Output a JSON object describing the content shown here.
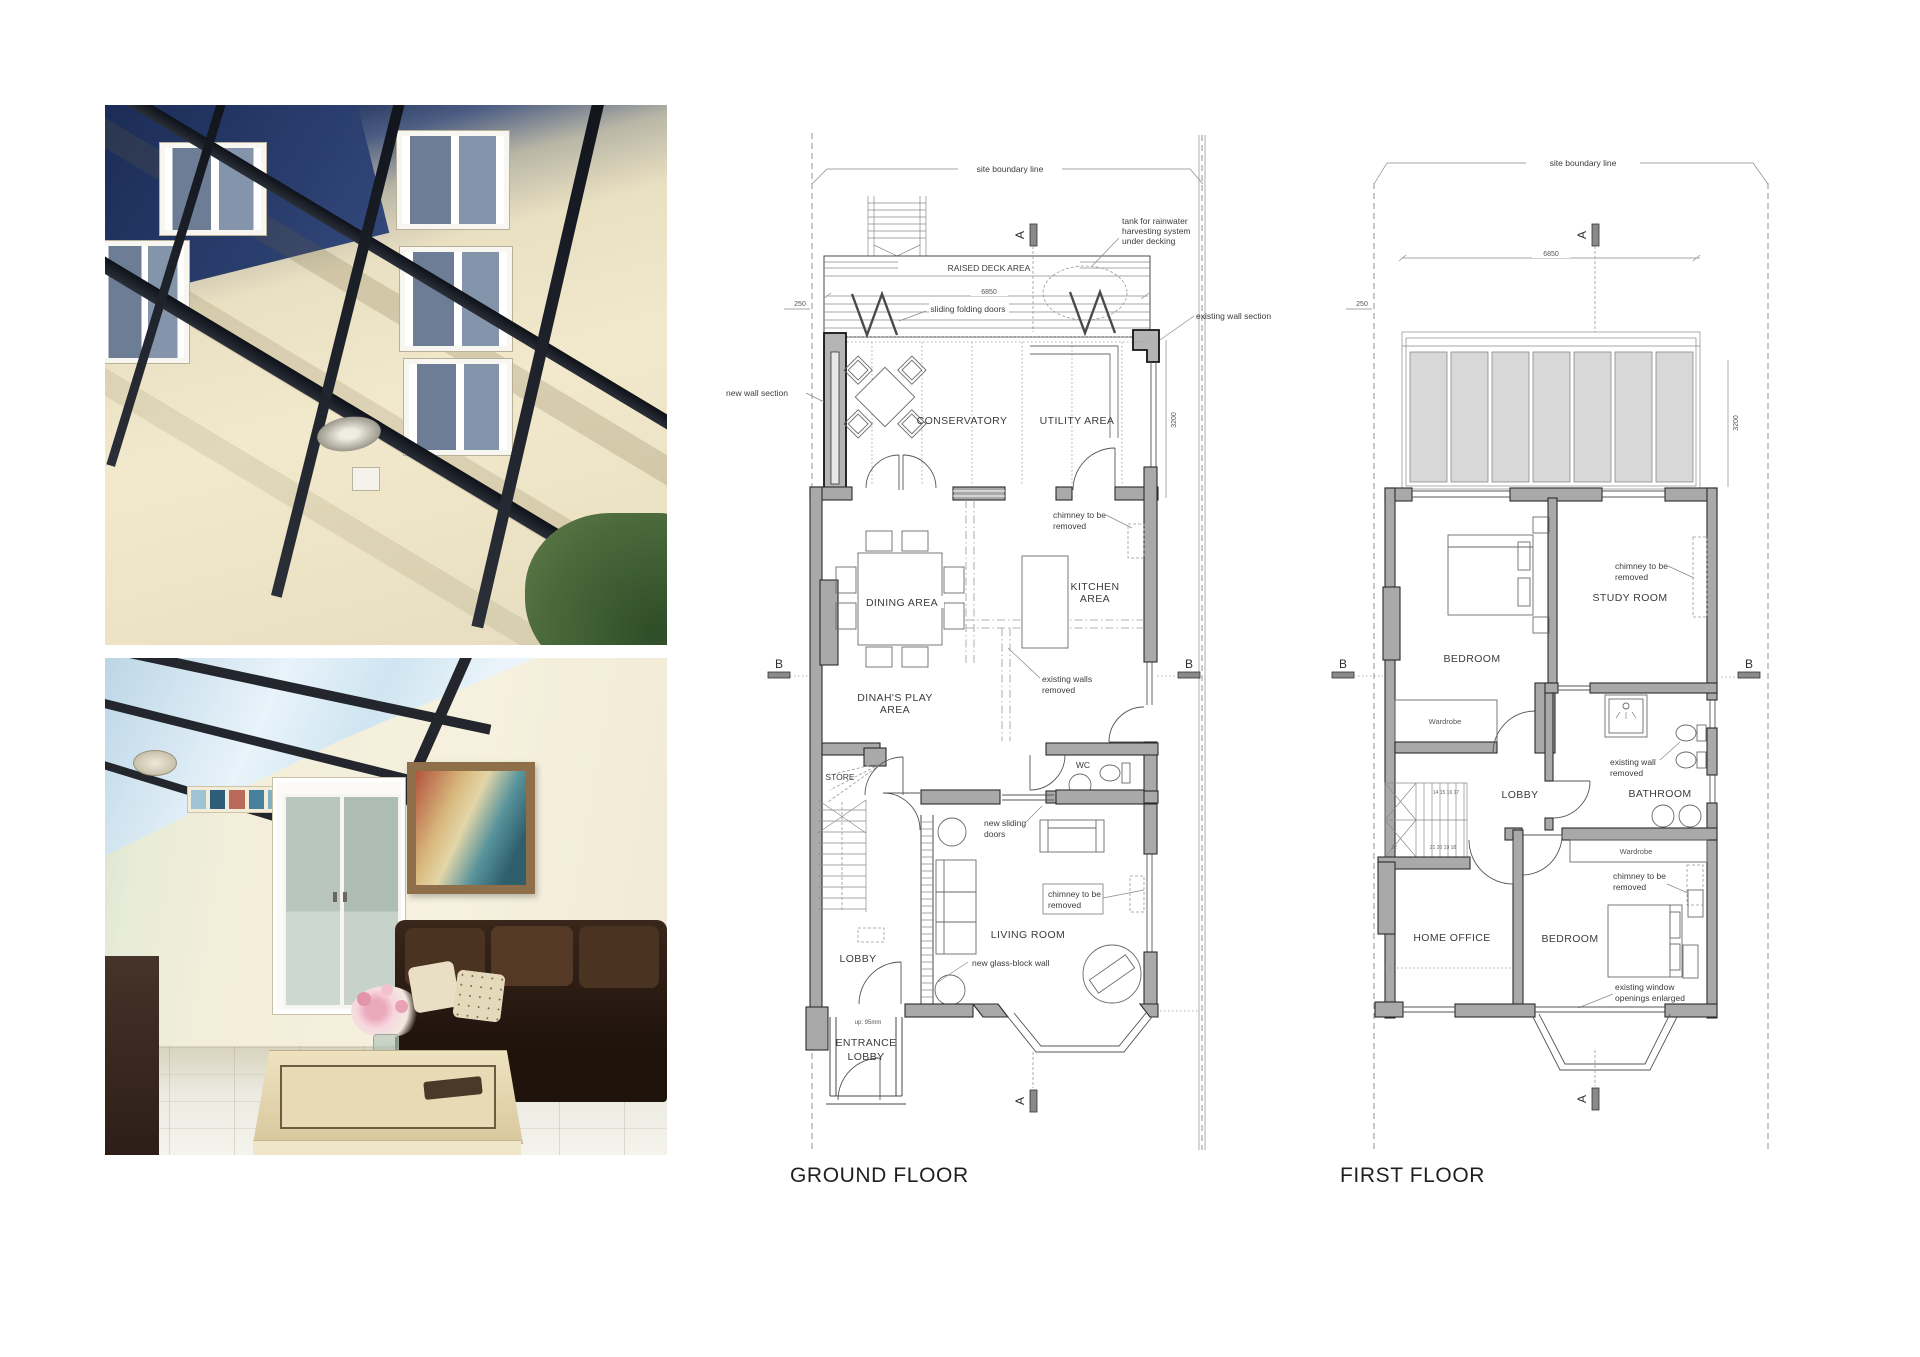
{
  "shared": {
    "site_boundary_line": "site boundary line",
    "marker_a": "A",
    "marker_b": "B",
    "dim_6850": "6850",
    "dim_250": "250",
    "dim_3200": "3200",
    "chimney_line1": "chimney to be",
    "chimney_line2": "removed",
    "wardrobe": "Wardrobe"
  },
  "ground_floor": {
    "title": "GROUND FLOOR",
    "raised_deck_area": "RAISED DECK AREA",
    "sliding_folding_doors": "sliding folding doors",
    "tank_line1": "tank for rainwater",
    "tank_line2": "harvesting system",
    "tank_line3": "under decking",
    "new_wall_section": "new wall section",
    "existing_wall_section": "existing wall section",
    "conservatory": "CONSERVATORY",
    "utility_area": "UTILITY AREA",
    "kitchen_line1": "KITCHEN",
    "kitchen_line2": "AREA",
    "dining_area": "DINING AREA",
    "existing_walls_line1": "existing walls",
    "existing_walls_line2": "removed",
    "play_line1": "DINAH'S PLAY",
    "play_line2": "AREA",
    "store": "STORE",
    "wc": "WC",
    "new_sliding_line1": "new sliding",
    "new_sliding_line2": "doors",
    "living_room": "LIVING ROOM",
    "lobby": "LOBBY",
    "glass_block_wall": "new glass-block wall",
    "entrance_line1": "ENTRANCE",
    "entrance_line2": "LOBBY",
    "up_note": "up: 95mm"
  },
  "first_floor": {
    "title": "FIRST FLOOR",
    "bedroom_front": "BEDROOM",
    "study_room": "STUDY ROOM",
    "lobby": "LOBBY",
    "bathroom": "BATHROOM",
    "existing_wall_line1": "existing wall",
    "existing_wall_line2": "removed",
    "home_office": "HOME OFFICE",
    "bedroom_rear": "BEDROOM",
    "window_note_line1": "existing window",
    "window_note_line2": "openings enlarged",
    "stairs_upper_numbers": "14  15  16  17",
    "stairs_num_22": "22",
    "stairs_lower_numbers": "21  20  19  18"
  },
  "colors": {
    "wall_gray": "#a9a9a9",
    "glazing_panel": "#d8d8d8",
    "line_dark": "#3c3c3c"
  }
}
